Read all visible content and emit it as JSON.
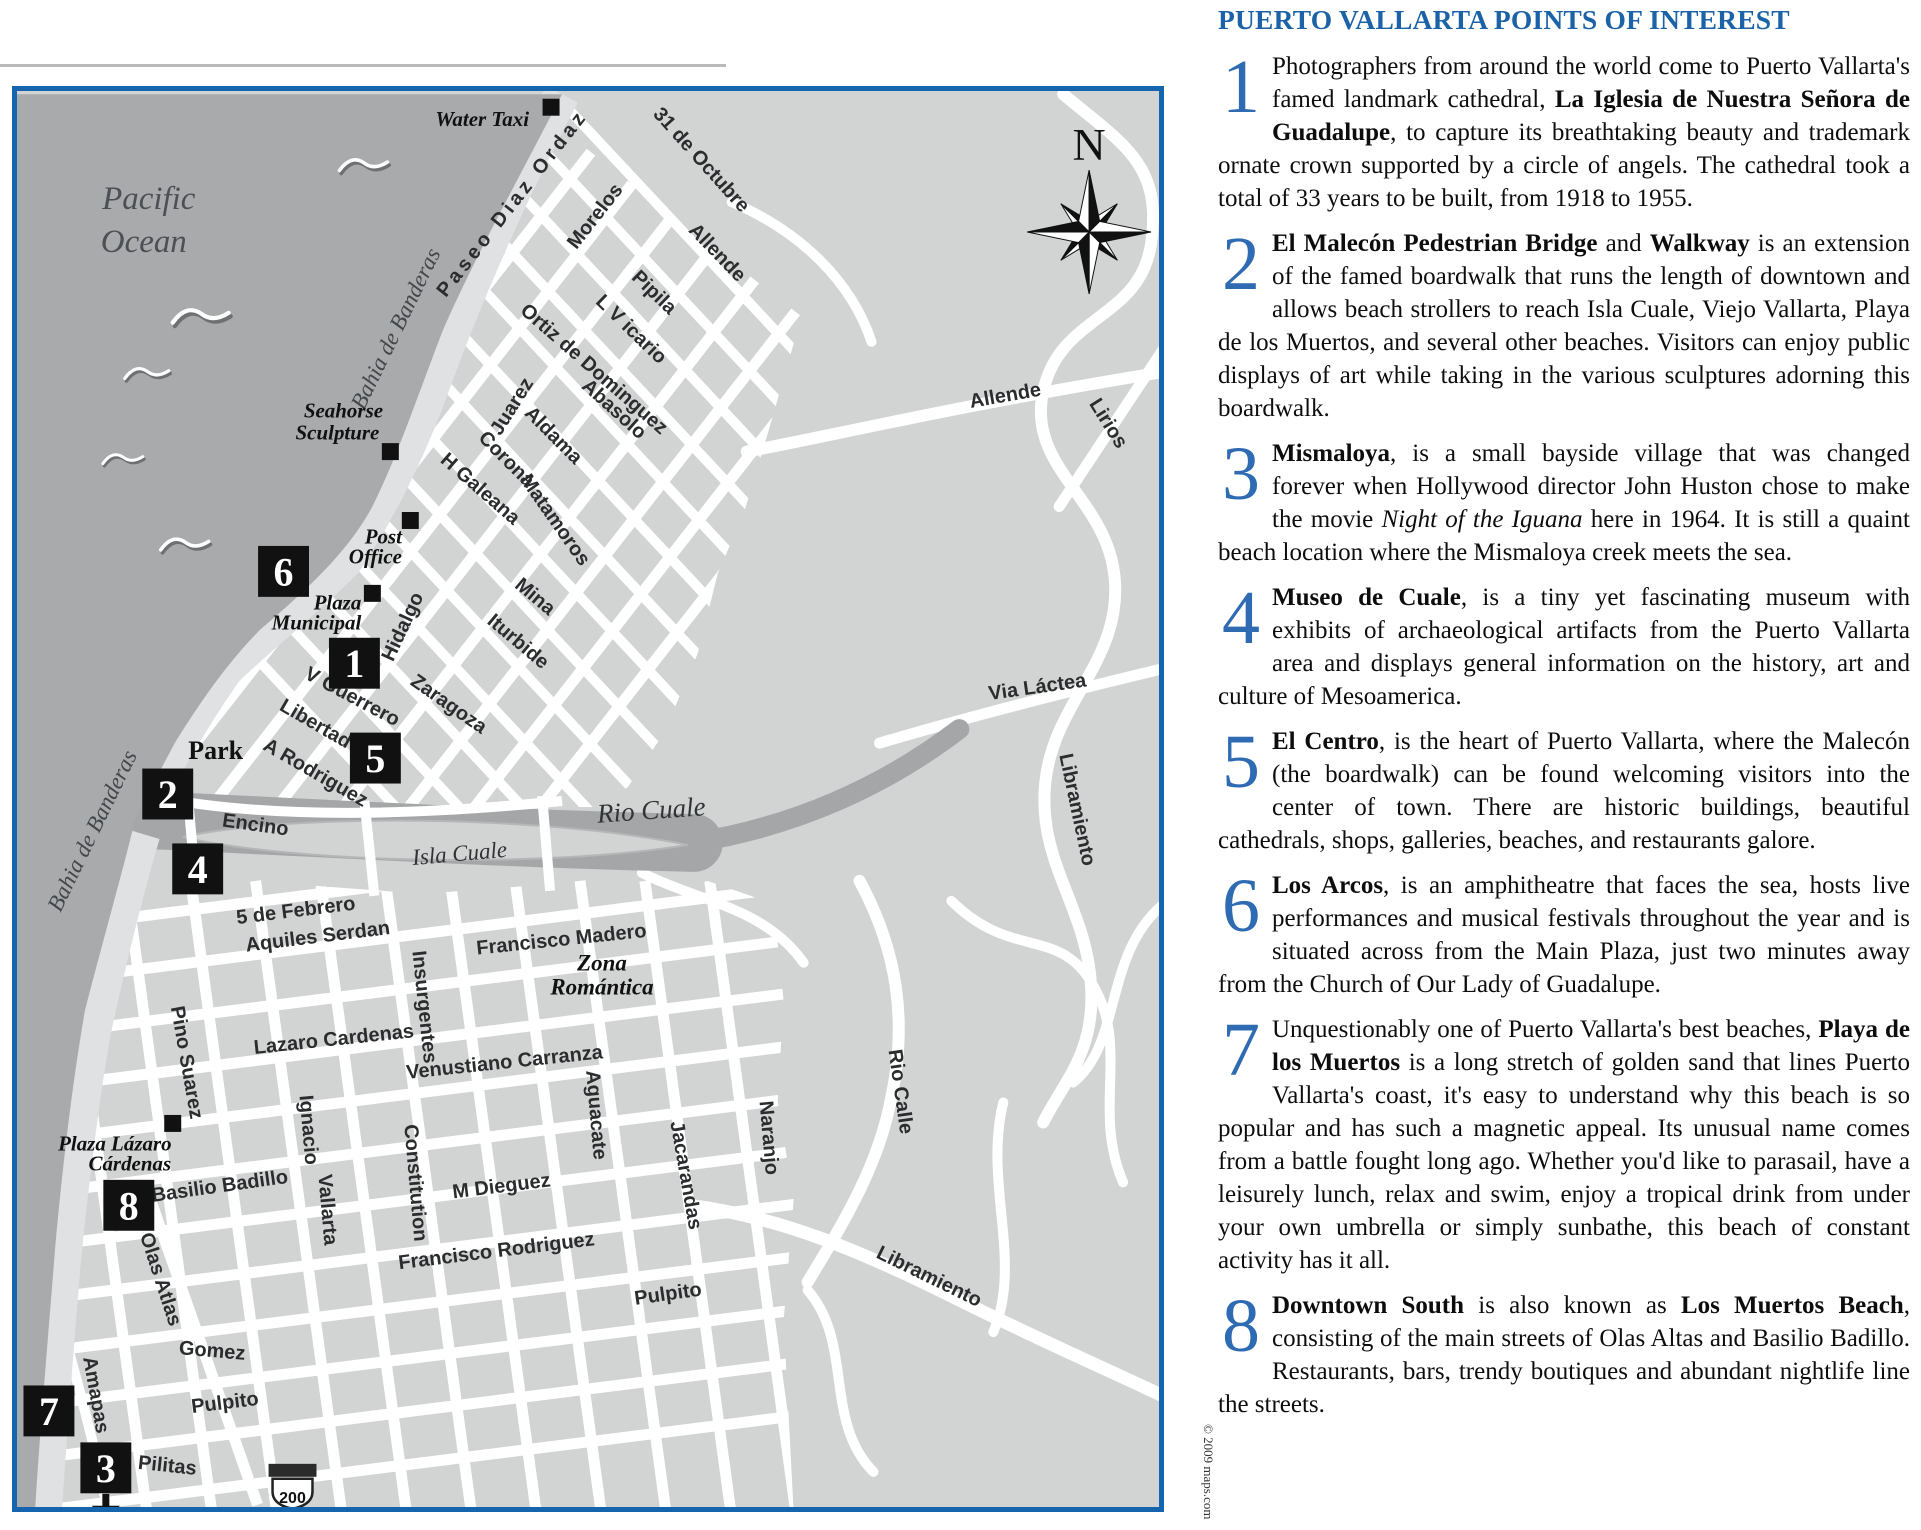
{
  "page": {
    "copyright": "© 2009 maps.com"
  },
  "colors": {
    "border_blue": "#1565ae",
    "title_blue": "#1b62a6",
    "numeral_blue": "#2e6bb2",
    "ocean_gray": "#a8aaac",
    "land_gray": "#d2d4d3",
    "shore_gray": "#dfe1e2",
    "street_white": "#ffffff"
  },
  "map": {
    "compass_label": "N",
    "highway_shield": "200",
    "markers": [
      {
        "n": "6",
        "x": 281,
        "y": 570
      },
      {
        "n": "1",
        "x": 352,
        "y": 662
      },
      {
        "n": "5",
        "x": 373,
        "y": 757
      },
      {
        "n": "2",
        "x": 165,
        "y": 793
      },
      {
        "n": "4",
        "x": 195,
        "y": 868
      },
      {
        "n": "8",
        "x": 126,
        "y": 1205
      },
      {
        "n": "7",
        "x": 46,
        "y": 1411
      },
      {
        "n": "3",
        "x": 103,
        "y": 1468
      }
    ],
    "poi_squares": [
      {
        "x": 549,
        "y": 105
      },
      {
        "x": 388,
        "y": 450
      },
      {
        "x": 408,
        "y": 519
      },
      {
        "x": 370,
        "y": 592
      },
      {
        "x": 170,
        "y": 1123
      }
    ],
    "labels": [
      {
        "t": "Pacific",
        "x": 146,
        "y": 207,
        "r": 0,
        "c": "lbl-pac"
      },
      {
        "t": "Ocean",
        "x": 141,
        "y": 250,
        "r": 0,
        "c": "lbl-pac"
      },
      {
        "t": "Bahia de Banderas",
        "x": 400,
        "y": 330,
        "r": -64,
        "c": "lbl-wat"
      },
      {
        "t": "Bahia de Banderas",
        "x": 96,
        "y": 833,
        "r": -64,
        "c": "lbl-wat"
      },
      {
        "t": "Water Taxi",
        "x": 480,
        "y": 124,
        "r": 0,
        "c": "lbl-pl",
        "s": 23
      },
      {
        "t": "Seahorse",
        "x": 341,
        "y": 416,
        "r": 0,
        "c": "lbl-pl"
      },
      {
        "t": "Sculpture",
        "x": 335,
        "y": 438,
        "r": 0,
        "c": "lbl-pl"
      },
      {
        "t": "Post",
        "x": 381,
        "y": 542,
        "r": 0,
        "c": "lbl-pl"
      },
      {
        "t": "Office",
        "x": 373,
        "y": 562,
        "r": 0,
        "c": "lbl-pl"
      },
      {
        "t": "Plaza",
        "x": 335,
        "y": 608,
        "r": 0,
        "c": "lbl-pl"
      },
      {
        "t": "Municipal",
        "x": 314,
        "y": 628,
        "r": 0,
        "c": "lbl-pl"
      },
      {
        "t": "Park",
        "x": 213,
        "y": 758,
        "r": 0,
        "c": "lbl-park"
      },
      {
        "t": "Plaza Lázaro",
        "x": 112,
        "y": 1150,
        "r": 0,
        "c": "lbl-pl"
      },
      {
        "t": "Cárdenas",
        "x": 127,
        "y": 1170,
        "r": 0,
        "c": "lbl-pl"
      },
      {
        "t": "Rio Cuale",
        "x": 650,
        "y": 818,
        "r": -4,
        "c": "lbl-riv"
      },
      {
        "t": "Isla Cuale",
        "x": 458,
        "y": 860,
        "r": -5,
        "c": "lbl-isl"
      },
      {
        "t": "Zona",
        "x": 600,
        "y": 970,
        "r": 0,
        "c": "lbl-zona"
      },
      {
        "t": "Romántica",
        "x": 600,
        "y": 994,
        "r": 0,
        "c": "lbl-zona"
      },
      {
        "t": "Paseo Diaz Ordaz",
        "x": 515,
        "y": 205,
        "r": -52,
        "c": "lbl-st",
        "ls": 4,
        "s": 21
      },
      {
        "t": "Morelos",
        "x": 598,
        "y": 218,
        "r": -52,
        "c": "lbl-st"
      },
      {
        "t": "31 de Octubre",
        "x": 695,
        "y": 162,
        "r": 48,
        "c": "lbl-st"
      },
      {
        "t": "Allende",
        "x": 711,
        "y": 255,
        "r": 46,
        "c": "lbl-st"
      },
      {
        "t": "Pipila",
        "x": 648,
        "y": 295,
        "r": 44,
        "c": "lbl-st"
      },
      {
        "t": "L V icario",
        "x": 625,
        "y": 332,
        "r": 44,
        "c": "lbl-st"
      },
      {
        "t": "Ortiz de Dominguez",
        "x": 588,
        "y": 372,
        "r": 41,
        "c": "lbl-st"
      },
      {
        "t": "Juarez",
        "x": 515,
        "y": 408,
        "r": -58,
        "c": "lbl-st"
      },
      {
        "t": "Abasolo",
        "x": 608,
        "y": 412,
        "r": 42,
        "c": "lbl-st"
      },
      {
        "t": "Aldama",
        "x": 547,
        "y": 438,
        "r": 45,
        "c": "lbl-st"
      },
      {
        "t": "Corona",
        "x": 500,
        "y": 462,
        "r": 45,
        "c": "lbl-st"
      },
      {
        "t": "H Galeana",
        "x": 474,
        "y": 492,
        "r": 41,
        "c": "lbl-st"
      },
      {
        "t": "Matamoros",
        "x": 548,
        "y": 522,
        "r": 55,
        "c": "lbl-st"
      },
      {
        "t": "Mina",
        "x": 529,
        "y": 600,
        "r": 40,
        "c": "lbl-st"
      },
      {
        "t": "Iturbide",
        "x": 512,
        "y": 645,
        "r": 40,
        "c": "lbl-st"
      },
      {
        "t": "Hidalgo",
        "x": 406,
        "y": 628,
        "r": -65,
        "c": "lbl-st"
      },
      {
        "t": "Zaragoza",
        "x": 443,
        "y": 708,
        "r": 35,
        "c": "lbl-st"
      },
      {
        "t": "V Guerrero",
        "x": 347,
        "y": 701,
        "r": 28,
        "c": "lbl-st"
      },
      {
        "t": "Libertad",
        "x": 310,
        "y": 728,
        "r": 30,
        "c": "lbl-st"
      },
      {
        "t": "A Rodriguez",
        "x": 310,
        "y": 777,
        "r": 30,
        "c": "lbl-st"
      },
      {
        "t": "Encino",
        "x": 252,
        "y": 830,
        "r": 8,
        "c": "lbl-st"
      },
      {
        "t": "5 de Febrero",
        "x": 294,
        "y": 916,
        "r": -7,
        "c": "lbl-st"
      },
      {
        "t": "Aquiles Serdan",
        "x": 316,
        "y": 942,
        "r": -7,
        "c": "lbl-st"
      },
      {
        "t": "Francisco Madero",
        "x": 560,
        "y": 945,
        "r": -6,
        "c": "lbl-st"
      },
      {
        "t": "Lazaro Cardenas",
        "x": 332,
        "y": 1045,
        "r": -6,
        "c": "lbl-st"
      },
      {
        "t": "Venustiano Carranza",
        "x": 503,
        "y": 1068,
        "r": -6,
        "c": "lbl-st"
      },
      {
        "t": "Insurgentes",
        "x": 416,
        "y": 1007,
        "r": 84,
        "c": "lbl-st"
      },
      {
        "t": "Pino Suarez",
        "x": 178,
        "y": 1063,
        "r": 80,
        "c": "lbl-st"
      },
      {
        "t": "Basilio Badillo",
        "x": 218,
        "y": 1192,
        "r": -8,
        "c": "lbl-st"
      },
      {
        "t": "M Dieguez",
        "x": 500,
        "y": 1192,
        "r": -7,
        "c": "lbl-st"
      },
      {
        "t": "Francisco Rodriguez",
        "x": 495,
        "y": 1257,
        "r": -7,
        "c": "lbl-st"
      },
      {
        "t": "Ignacio",
        "x": 300,
        "y": 1130,
        "r": 85,
        "c": "lbl-st"
      },
      {
        "t": "Vallarta",
        "x": 319,
        "y": 1210,
        "r": 85,
        "c": "lbl-st"
      },
      {
        "t": "Constitution",
        "x": 407,
        "y": 1183,
        "r": 85,
        "c": "lbl-st"
      },
      {
        "t": "Olas Atlas",
        "x": 152,
        "y": 1281,
        "r": 72,
        "c": "lbl-st"
      },
      {
        "t": "Amapas",
        "x": 87,
        "y": 1396,
        "r": 80,
        "c": "lbl-st"
      },
      {
        "t": "Gomez",
        "x": 209,
        "y": 1357,
        "r": 5,
        "c": "lbl-st"
      },
      {
        "t": "Pulpito",
        "x": 223,
        "y": 1409,
        "r": -7,
        "c": "lbl-st"
      },
      {
        "t": "Pulpito",
        "x": 667,
        "y": 1300,
        "r": -8,
        "c": "lbl-st"
      },
      {
        "t": "Pilitas",
        "x": 164,
        "y": 1472,
        "r": 6,
        "c": "lbl-st"
      },
      {
        "t": "Aguacate",
        "x": 588,
        "y": 1115,
        "r": 85,
        "c": "lbl-st"
      },
      {
        "t": "Jacarandas",
        "x": 678,
        "y": 1176,
        "r": 80,
        "c": "lbl-st"
      },
      {
        "t": "Naranjo",
        "x": 761,
        "y": 1138,
        "r": 85,
        "c": "lbl-st"
      },
      {
        "t": "Allende",
        "x": 1005,
        "y": 400,
        "r": -10,
        "c": "lbl-st"
      },
      {
        "t": "Lirios",
        "x": 1102,
        "y": 425,
        "r": 58,
        "c": "lbl-st"
      },
      {
        "t": "Via Láctea",
        "x": 1037,
        "y": 692,
        "r": -8,
        "c": "lbl-st"
      },
      {
        "t": "Libramiento",
        "x": 1070,
        "y": 810,
        "r": 78,
        "c": "lbl-st"
      },
      {
        "t": "Rio Calle",
        "x": 893,
        "y": 1092,
        "r": 82,
        "c": "lbl-st"
      },
      {
        "t": "Libramiento",
        "x": 925,
        "y": 1282,
        "r": 26,
        "c": "lbl-st"
      }
    ]
  },
  "sidebar": {
    "title": "PUERTO VALLARTA POINTS OF INTEREST",
    "items": [
      {
        "num": "1",
        "runs": [
          {
            "t": "Photographers from around the world come to Puerto Vallarta's famed landmark cathedral, "
          },
          {
            "t": "La Iglesia de Nuestra Señora de Guadalupe",
            "b": true
          },
          {
            "t": ", to capture its breathtaking beauty and trademark ornate crown supported by a circle of angels. The cathedral took a total of 33 years to be built, from 1918 to 1955."
          }
        ]
      },
      {
        "num": "2",
        "runs": [
          {
            "t": "El Malecón Pedestrian Bridge",
            "b": true
          },
          {
            "t": " and "
          },
          {
            "t": "Walkway",
            "b": true
          },
          {
            "t": " is an extension of the famed boardwalk that runs the length of downtown and allows beach strollers to reach Isla Cuale, Viejo Vallarta, Playa de los Muertos, and several other beaches. Visitors can enjoy public displays of art while taking in the various sculptures adorning this boardwalk."
          }
        ]
      },
      {
        "num": "3",
        "runs": [
          {
            "t": "Mismaloya",
            "b": true
          },
          {
            "t": ", is a small bayside village that was changed forever when Hollywood director John Huston chose to make the movie "
          },
          {
            "t": "Night of the Iguana",
            "i": true
          },
          {
            "t": " here in 1964. It is still a quaint beach location where the Mismaloya creek meets the sea."
          }
        ]
      },
      {
        "num": "4",
        "runs": [
          {
            "t": "Museo de Cuale",
            "b": true
          },
          {
            "t": ", is a tiny yet fascinating museum with exhibits of archaeological artifacts from the Puerto Vallarta area and displays general information on the history, art and culture of Mesoamerica."
          }
        ]
      },
      {
        "num": "5",
        "runs": [
          {
            "t": "El Centro",
            "b": true
          },
          {
            "t": ", is the heart of Puerto Vallarta, where the Malecón (the boardwalk) can be found welcoming visitors into the center of town. There are historic buildings, beautiful cathedrals, shops, galleries, beaches, and restaurants galore."
          }
        ]
      },
      {
        "num": "6",
        "runs": [
          {
            "t": "Los Arcos",
            "b": true
          },
          {
            "t": ", is an amphitheatre that faces the sea, hosts live performances and musical festivals throughout the year and is situated across from the Main Plaza, just two minutes away from the Church of Our Lady of Guadalupe."
          }
        ]
      },
      {
        "num": "7",
        "runs": [
          {
            "t": "Unquestionably one of Puerto Vallarta's best beaches, "
          },
          {
            "t": "Playa de los Muertos",
            "b": true
          },
          {
            "t": " is a long stretch of golden sand that lines Puerto Vallarta's coast, it's easy to understand why this beach is so popular and has such a magnetic appeal. Its unusual name comes from a battle fought long ago. Whether you'd like to parasail, have a leisurely lunch, relax and swim, enjoy a tropical drink from under your own umbrella or simply sunbathe, this beach of constant activity has it all."
          }
        ]
      },
      {
        "num": "8",
        "runs": [
          {
            "t": "Downtown South",
            "b": true
          },
          {
            "t": " is also known as "
          },
          {
            "t": "Los Muertos Beach",
            "b": true
          },
          {
            "t": ", consisting of the main streets of Olas Altas and Basilio Badillo. Restaurants, bars, trendy boutiques and abundant nightlife line the streets."
          }
        ]
      }
    ]
  }
}
